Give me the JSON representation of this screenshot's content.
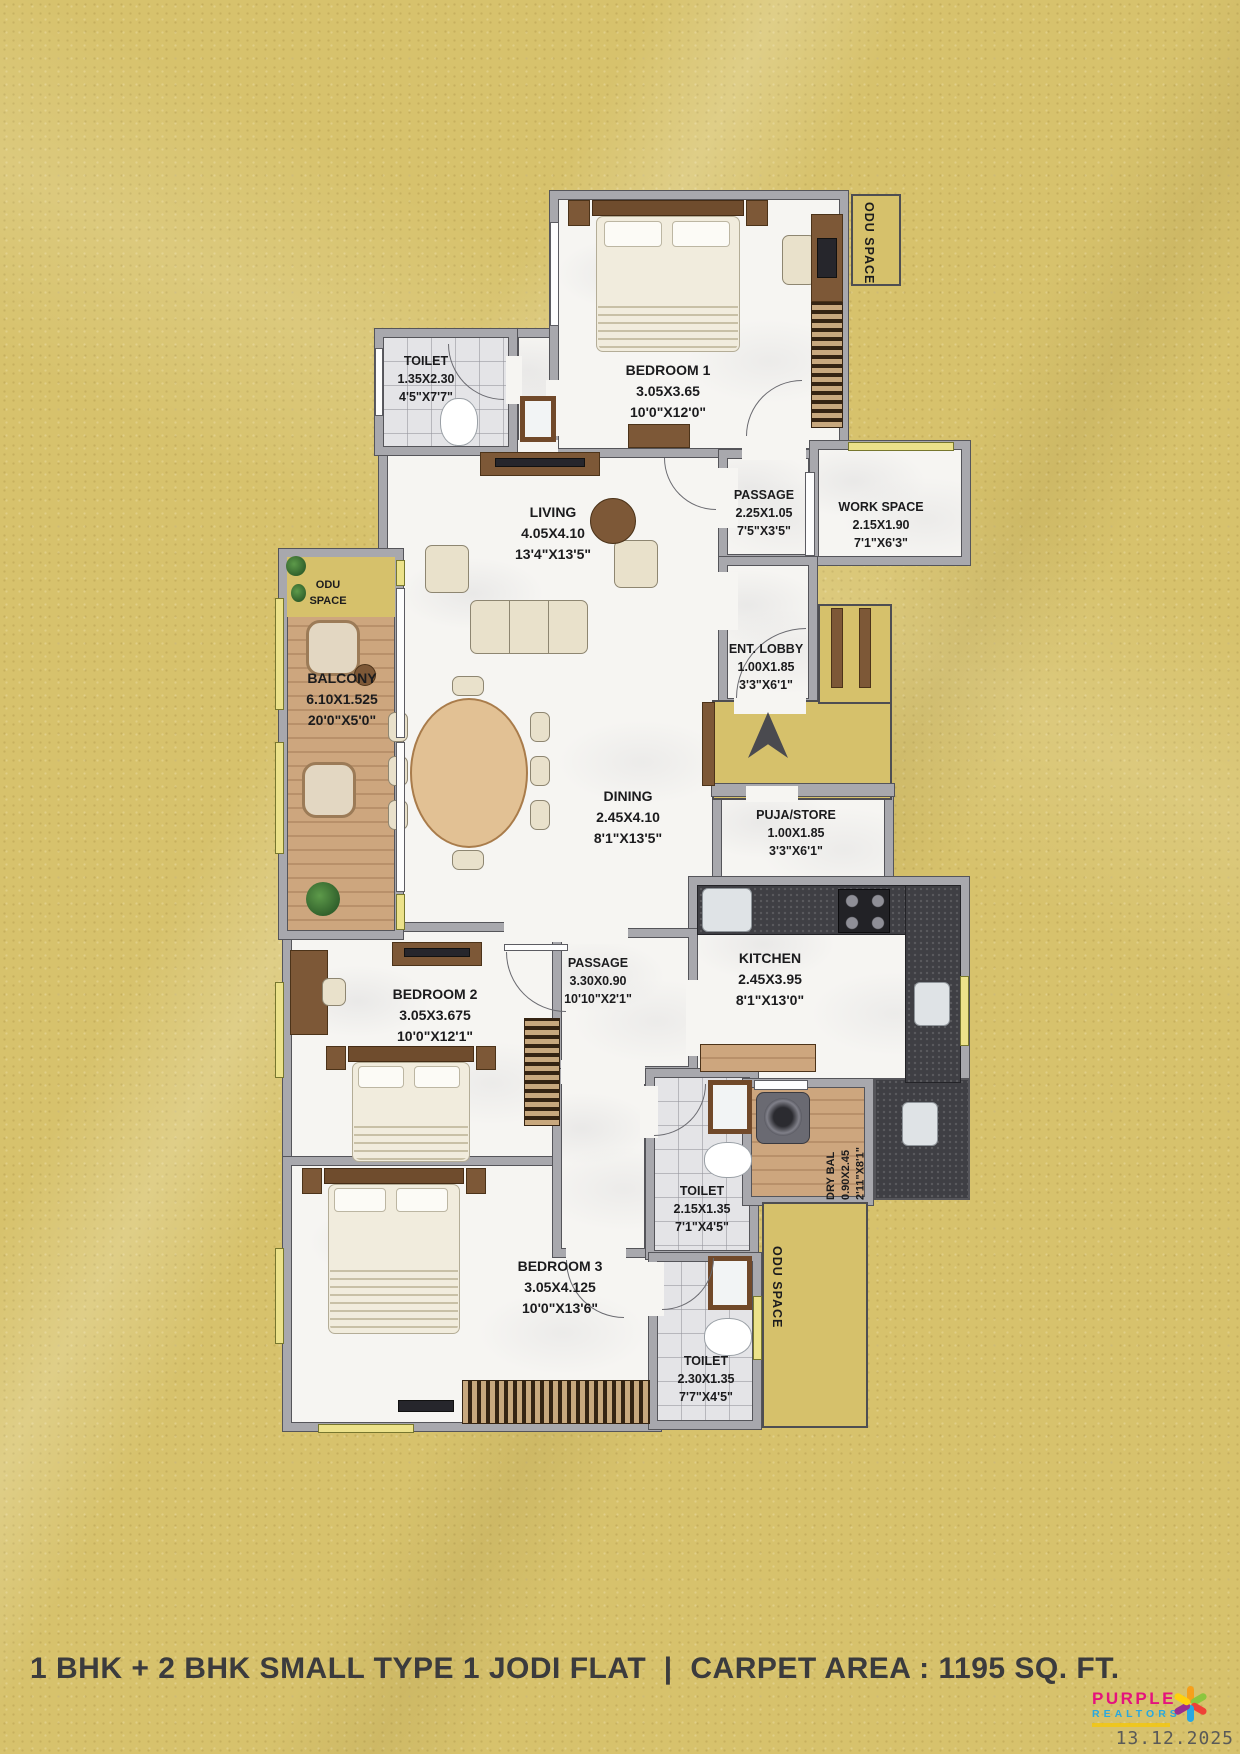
{
  "rooms": {
    "bedroom1": {
      "name": "BEDROOM 1",
      "m": "3.05X3.65",
      "ft": "10'0\"X12'0\""
    },
    "toilet_top": {
      "name": "TOILET",
      "m": "1.35X2.30",
      "ft": "4'5\"X7'7\""
    },
    "living": {
      "name": "LIVING",
      "m": "4.05X4.10",
      "ft": "13'4\"X13'5\""
    },
    "passage_top": {
      "name": "PASSAGE",
      "m": "2.25X1.05",
      "ft": "7'5\"X3'5\""
    },
    "work_space": {
      "name": "WORK SPACE",
      "m": "2.15X1.90",
      "ft": "7'1\"X6'3\""
    },
    "balcony": {
      "name": "BALCONY",
      "m": "6.10X1.525",
      "ft": "20'0\"X5'0\""
    },
    "ent_lobby": {
      "name": "ENT. LOBBY",
      "m": "1.00X1.85",
      "ft": "3'3\"X6'1\""
    },
    "dining": {
      "name": "DINING",
      "m": "2.45X4.10",
      "ft": "8'1\"X13'5\""
    },
    "puja_store": {
      "name": "PUJA/STORE",
      "m": "1.00X1.85",
      "ft": "3'3\"X6'1\""
    },
    "bedroom2": {
      "name": "BEDROOM 2",
      "m": "3.05X3.675",
      "ft": "10'0\"X12'1\""
    },
    "passage_mid": {
      "name": "PASSAGE",
      "m": "3.30X0.90",
      "ft": "10'10\"X2'1\""
    },
    "kitchen": {
      "name": "KITCHEN",
      "m": "2.45X3.95",
      "ft": "8'1\"X13'0\""
    },
    "dry_bal": {
      "name": "DRY BAL",
      "m": "0.90X2.45",
      "ft": "2'11\"X8'1\""
    },
    "toilet_mid": {
      "name": "TOILET",
      "m": "2.15X1.35",
      "ft": "7'1\"X4'5\""
    },
    "bedroom3": {
      "name": "BEDROOM 3",
      "m": "3.05X4.125",
      "ft": "10'0\"X13'6\""
    },
    "toilet_bot": {
      "name": "TOILET",
      "m": "2.30X1.35",
      "ft": "7'7\"X4'5\""
    }
  },
  "odu": {
    "top_right": "ODU SPACE",
    "left_line1": "ODU",
    "left_line2": "SPACE",
    "bottom_right": "ODU SPACE"
  },
  "footer": {
    "caption": "1 BHK + 2 BHK SMALL TYPE 1 JODI FLAT  |  CARPET AREA : 1195 SQ. FT.",
    "date": "13.12.2025"
  },
  "logo": {
    "name_top": "PURPLE",
    "name_bottom": "REALTORS"
  },
  "colors": {
    "background_gold": "#d7c26c",
    "wall_gray": "#a8a8ad",
    "logo_pink": "#e5127d",
    "logo_blue": "#29a8df",
    "window_yellow": "#ece28a"
  }
}
